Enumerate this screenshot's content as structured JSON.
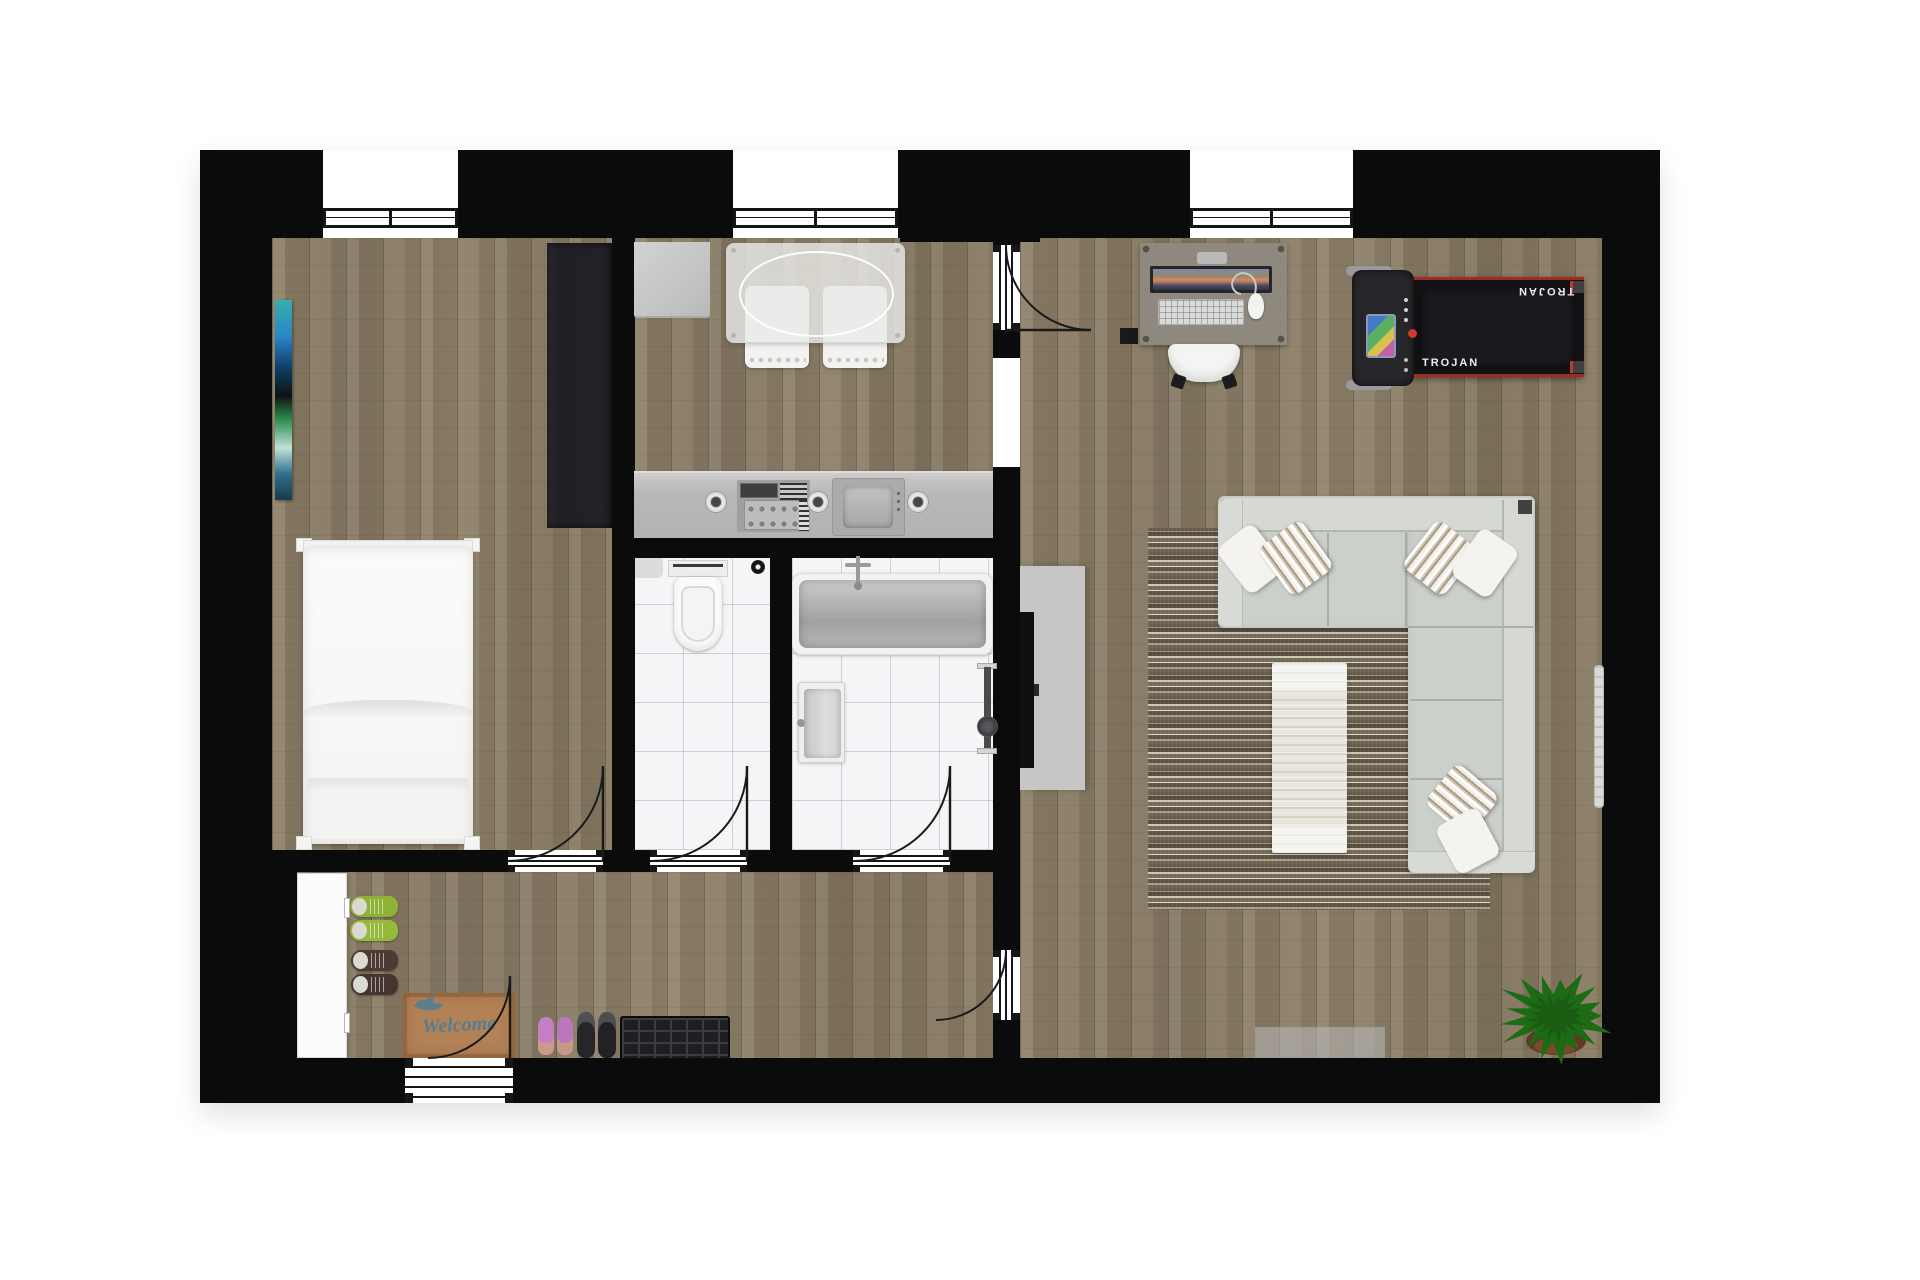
{
  "scene": {
    "kind": "apartment-floor-plan-top-view-render",
    "background": "#ffffff",
    "wall_color": "#0b0b0c"
  },
  "labels": {
    "treadmill_brand": "TROJAN",
    "doormat_text": "Welcome"
  },
  "palette": {
    "wood_floor": "#887b67",
    "tile_floor": "#f5f5f7",
    "rug_base": "#7d7263",
    "sofa": "#ccd0ca",
    "counter": "#bcbcbc",
    "wardrobe": "#232327",
    "treadmill_body": "#111114",
    "treadmill_accent": "#b03228",
    "plant_green": "#1e6b15",
    "welcome_mat": "#b28156",
    "welcome_text": "#567d90",
    "bed_linen": "#fafaf8"
  },
  "rooms": [
    {
      "id": "bedroom",
      "floor": "wood",
      "items": [
        "wall-art",
        "wardrobe",
        "double-bed"
      ]
    },
    {
      "id": "kitchen",
      "floor": "wood",
      "items": [
        "fridge-cabinet",
        "dining-table",
        "dining-chairs",
        "kitchen-counter",
        "cooktop",
        "sink"
      ]
    },
    {
      "id": "wc",
      "floor": "tile",
      "items": [
        "corner-shelf",
        "floor-drain",
        "toilet"
      ]
    },
    {
      "id": "bathroom",
      "floor": "tile",
      "items": [
        "bathtub",
        "bath-faucet",
        "washbasin",
        "towel-radiator"
      ]
    },
    {
      "id": "hallway",
      "floor": "wood",
      "items": [
        "shoe-cabinet",
        "green-sneakers",
        "brown-shoes",
        "pink-flats",
        "black-shoes",
        "shoe-bench",
        "welcome-mat"
      ]
    },
    {
      "id": "living-room",
      "floor": "wood",
      "items": [
        "desk",
        "monitor",
        "keyboard",
        "mouse",
        "desk-chair",
        "pc-tower",
        "treadmill",
        "corner-sofa",
        "cushions",
        "area-rug",
        "coffee-bench",
        "tv-sideboard",
        "tv",
        "wall-radiator",
        "floor-mat",
        "potted-plant"
      ]
    }
  ],
  "openings": {
    "windows": 3,
    "interior_doors": 5,
    "entry_doors": 1,
    "wall_openings": 1
  }
}
